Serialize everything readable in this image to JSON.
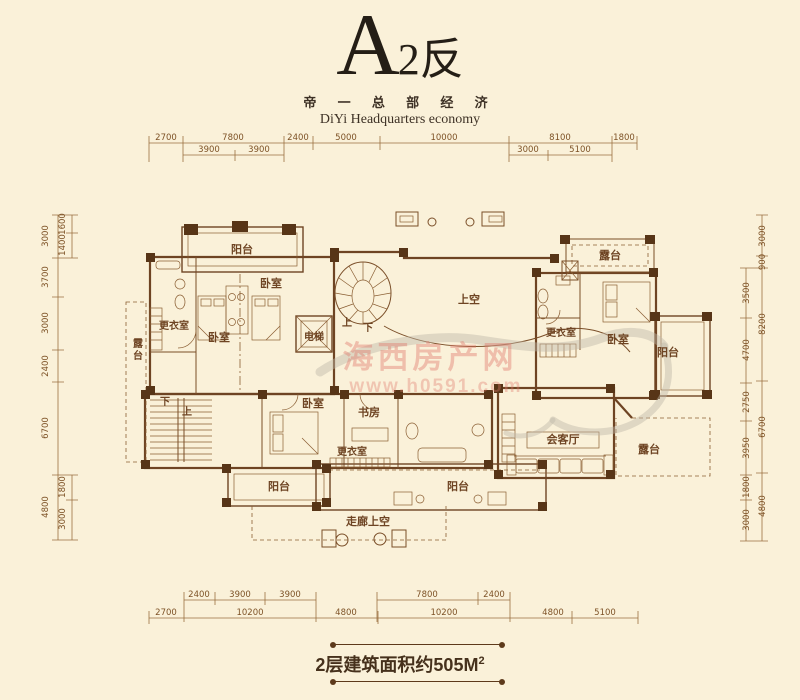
{
  "page": {
    "background": "#FAF1D9"
  },
  "title": {
    "letter": "A",
    "suffix": "2反",
    "subtitle_cn": "帝 一 总 部 经 济",
    "subtitle_en": "DiYi Headquarters economy"
  },
  "watermark": {
    "name": "海西房产网",
    "url": "www.h0591.com"
  },
  "footer": {
    "area_label": "2层建筑面积约505M",
    "area_sup": "2"
  },
  "dims": {
    "top1": [
      "2700",
      "7800",
      "2400",
      "5000",
      "10000",
      "8100",
      "1800"
    ],
    "top2": [
      "3900",
      "3900",
      "3000",
      "5100"
    ],
    "bottom1": [
      "2400",
      "3900",
      "3900",
      "7800",
      "2400"
    ],
    "bottom2": [
      "2700",
      "10200",
      "4800",
      "10200",
      "4800",
      "5100"
    ],
    "left_outer": [
      "3000",
      "3700",
      "3000",
      "2400",
      "6700",
      "4800"
    ],
    "left_inner": [
      "1600",
      "1400",
      "1800",
      "3000"
    ],
    "right_inner": [
      "3500",
      "4700",
      "2750",
      "3950",
      "1800",
      "3000"
    ],
    "right_outer": [
      "3000",
      "900",
      "8200",
      "6700",
      "4800"
    ]
  },
  "rooms": {
    "balcony_top": "阳台",
    "bedroom_upper_left": "卧室",
    "closet_upper_left": "更衣室",
    "bedroom_lower_left": "卧室",
    "elevator": "电梯",
    "terrace_left": "露台",
    "void": "上空",
    "spiral_up": "上",
    "spiral_down": "下",
    "stair_down": "下",
    "stair_up": "上",
    "bedroom_lower": "卧室",
    "study": "书房",
    "closet_lower": "更衣室",
    "balcony_bottom_left": "阳台",
    "balcony_bottom_center": "阳台",
    "corridor_void": "走廊上空",
    "reception": "会客厅",
    "terrace_bottom_right": "露台",
    "terrace_top_right": "露台",
    "closet_right": "更衣室",
    "bedroom_right": "卧室",
    "balcony_right": "阳台"
  }
}
